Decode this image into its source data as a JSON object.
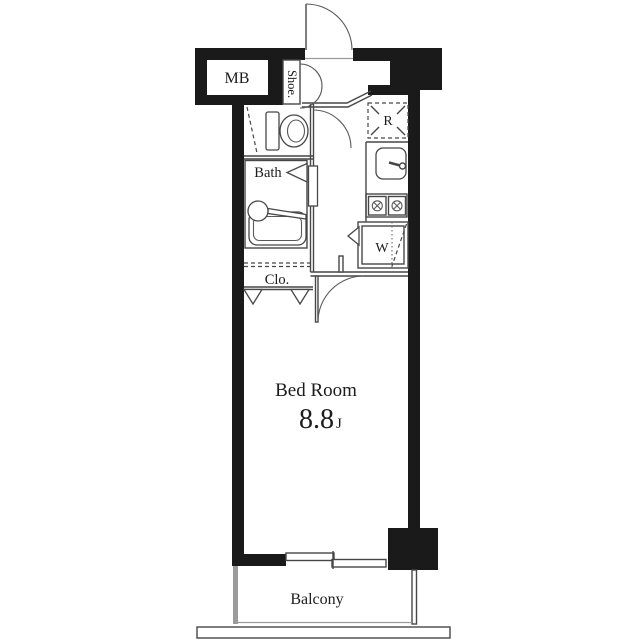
{
  "floor_plan": {
    "labels": {
      "meter_box": "MB",
      "shoe_closet": "Shoe.",
      "bath": "Bath",
      "closet": "Clo.",
      "refrigerator": "R",
      "washer": "W",
      "bedroom": "Bed Room",
      "bedroom_size": "8.8",
      "bedroom_size_unit": "J",
      "balcony": "Balcony"
    },
    "colors": {
      "wall": "#1a1a1a",
      "line": "#474747",
      "light_line": "#9b9b9b",
      "text": "#1c1c1c",
      "background": "#ffffff"
    }
  }
}
